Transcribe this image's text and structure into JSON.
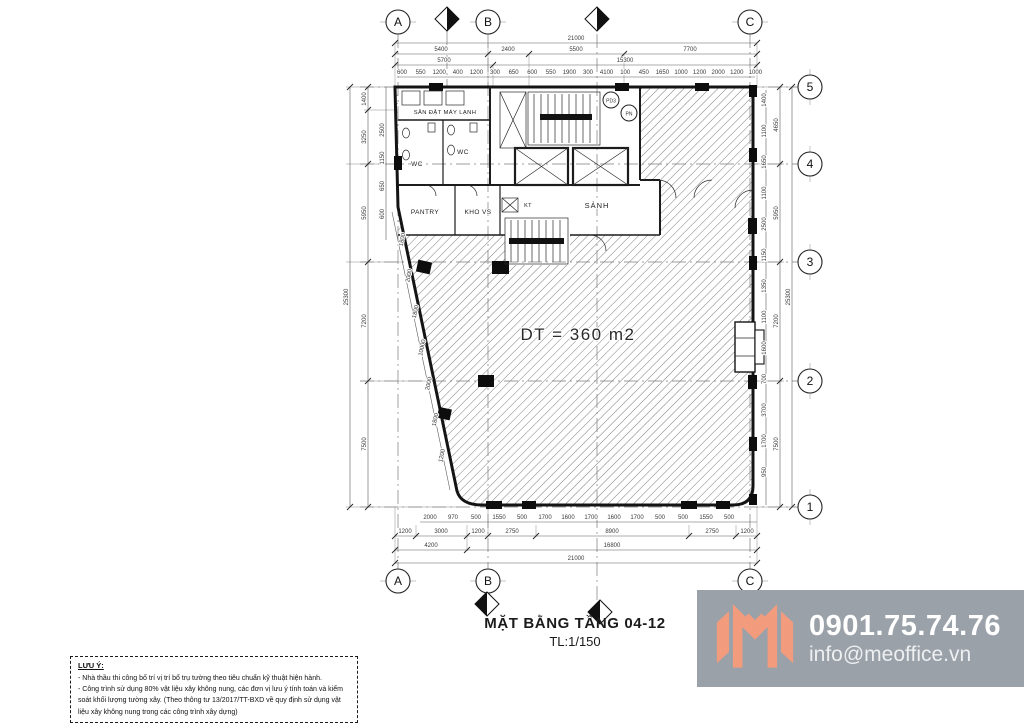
{
  "drawing": {
    "title": "MẶT BẰNG TẦNG 04-12",
    "scale": "TL:1/150",
    "area_label": "DT = 360 m2"
  },
  "grid": {
    "cols": [
      "A",
      "B",
      "C"
    ],
    "rows": [
      "5",
      "4",
      "3",
      "2",
      "1"
    ]
  },
  "rooms": {
    "ac_yard": "SÂN ĐẶT MÁY LẠNH",
    "wc": "WC",
    "pantry": "PANTRY",
    "storage": "KHO VS",
    "lobby": "SẢNH",
    "shaft_kt": "KT",
    "shaft_pd3": "PD3",
    "shaft_pn": "PN"
  },
  "dims": {
    "top": {
      "total": "21000",
      "spans": [
        "5400",
        "2400",
        "5500",
        "7700"
      ],
      "sub": [
        "5700",
        "15300"
      ],
      "detail": [
        "600",
        "550",
        "1200",
        "400",
        "1200",
        "300",
        "650",
        "600",
        "550",
        "1900",
        "300",
        "4100",
        "100",
        "450",
        "1650",
        "1000",
        "1200",
        "2000",
        "1200",
        "1000"
      ]
    },
    "bottom": {
      "total": "21000",
      "spans": [
        "4200",
        "16800"
      ],
      "sub": [
        "1200",
        "3000",
        "1200",
        "2750",
        "8900",
        "2750",
        "1200"
      ],
      "detail": [
        "2000",
        "970",
        "500",
        "1550",
        "500",
        "1700",
        "1600",
        "1700",
        "1600",
        "1700",
        "500",
        "500",
        "1550",
        "500"
      ]
    },
    "right": {
      "total": "25300",
      "spans": [
        "4650",
        "5950",
        "7200",
        "7500"
      ],
      "detail": [
        "1400",
        "1100",
        "1650",
        "1100",
        "2500",
        "1150",
        "1350",
        "1100",
        "1600",
        "700",
        "3700",
        "1700",
        "950"
      ]
    },
    "left": {
      "total": "25300",
      "spans": [
        "1400",
        "3250",
        "5950",
        "7200",
        "7500"
      ],
      "detail": [
        "2500",
        "1150",
        "650",
        "600"
      ]
    },
    "diagonal": [
      "1800",
      "2000",
      "1800",
      "10000",
      "2000",
      "1800",
      "1200"
    ]
  },
  "notes": {
    "heading": "LƯU Ý:",
    "lines": [
      "- Nhà thầu thi công bố trí vị trí bổ trụ tường theo tiêu chuẩn kỹ thuật hiện hành.",
      "- Công trình sử dụng 80% vật liệu xây không nung, các đơn vị lưu ý tính toán và kiểm soát khối lượng tường xây. (Theo thông tư 13/2017/TT-BXD về quy định sử dụng vật liệu xây không nung trong các công trình xây dựng)"
    ]
  },
  "branding": {
    "phone": "0901.75.74.76",
    "email": "info@meoffice.vn",
    "logo_color": "#F29C7D",
    "banner_bg": "#9aa1a9"
  }
}
